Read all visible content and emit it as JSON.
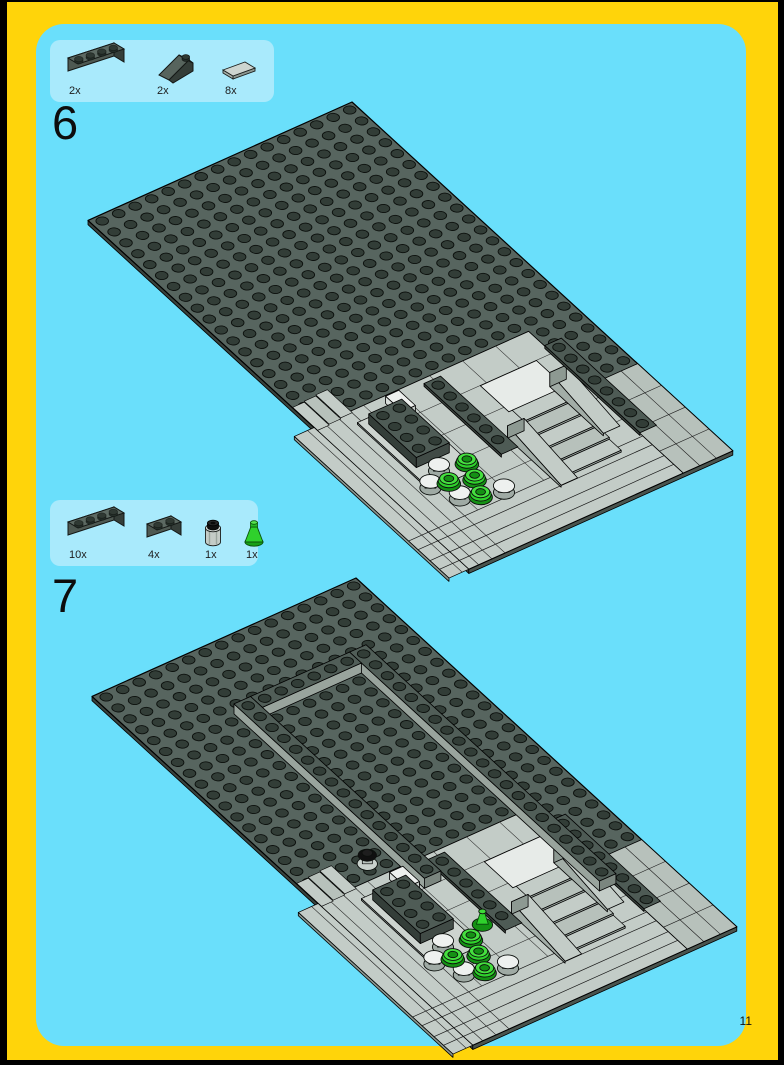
{
  "page": {
    "number": "11"
  },
  "palette": {
    "frame_yellow": "#FFD40A",
    "panel_blue": "#6ADFFB",
    "partsbox_blue": "#A9EAFC",
    "outer_black": "#000000",
    "plate_top": "#57655F",
    "plate_side": "#39423D",
    "plate_side2": "#4A544E",
    "stud": "#323D37",
    "light_top": "#C3CCC7",
    "light_top2": "#B7C1BB",
    "light_mid": "#A2ADA7",
    "light_side": "#8D9992",
    "wall_face": "#99A49D",
    "wall_face2": "#7B867F",
    "wall_top": "#515E58",
    "brick_top": "#4F5C56",
    "brick_front": "#343E39",
    "brick_end": "#414B46",
    "white_piece": "#E7EBE8",
    "green": "#2FD12C",
    "green_dark": "#149114",
    "black_piece": "#101010"
  },
  "steps": [
    {
      "number": "6",
      "parts": [
        {
          "part": "brick-1x4-dark-gray",
          "count": "2x"
        },
        {
          "part": "slope-1x2-dark-gray",
          "count": "2x"
        },
        {
          "part": "tile-1x2-light-gray",
          "count": "8x"
        }
      ]
    },
    {
      "number": "7",
      "parts": [
        {
          "part": "brick-1x4-dark-gray",
          "count": "10x"
        },
        {
          "part": "brick-1x2-dark-gray",
          "count": "4x"
        },
        {
          "part": "round-brick-1x1-light-with-black-plate",
          "count": "1x"
        },
        {
          "part": "cone-1x1-green",
          "count": "1x"
        }
      ]
    }
  ]
}
